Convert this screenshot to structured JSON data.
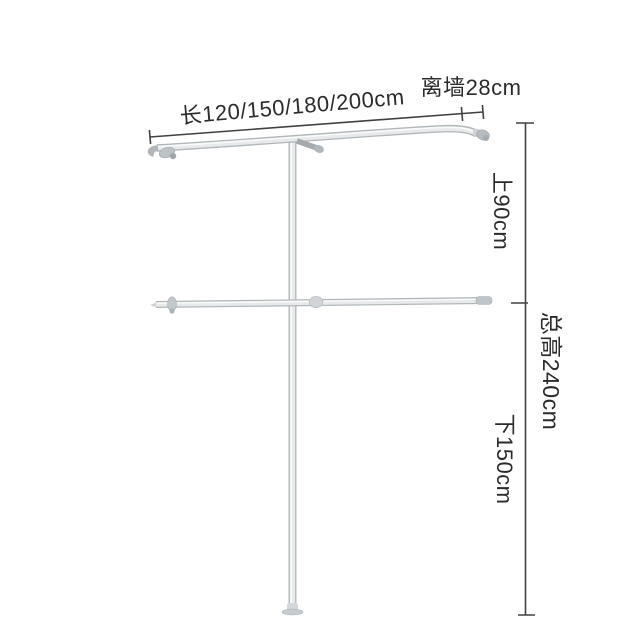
{
  "diagram": {
    "title_hint": "wall-mounted clothes rail dimension diagram",
    "labels": {
      "length": "长120/150/180/200cm",
      "wall_distance": "离墙28cm",
      "upper_section": "上90cm",
      "total_height": "总高240cm",
      "lower_section": "下150cm"
    },
    "measurements": {
      "length_options_cm": [
        120,
        150,
        180,
        200
      ],
      "wall_distance_cm": 28,
      "upper_section_cm": 90,
      "total_height_cm": 240,
      "lower_section_cm": 150
    },
    "colors": {
      "background": "#ffffff",
      "dimension_line": "#414141",
      "text": "#2b2b2b",
      "tube_edge": "#b0b6b9",
      "tube_fill": "#e7e9ea",
      "fitting": "#b6bcc0"
    }
  }
}
